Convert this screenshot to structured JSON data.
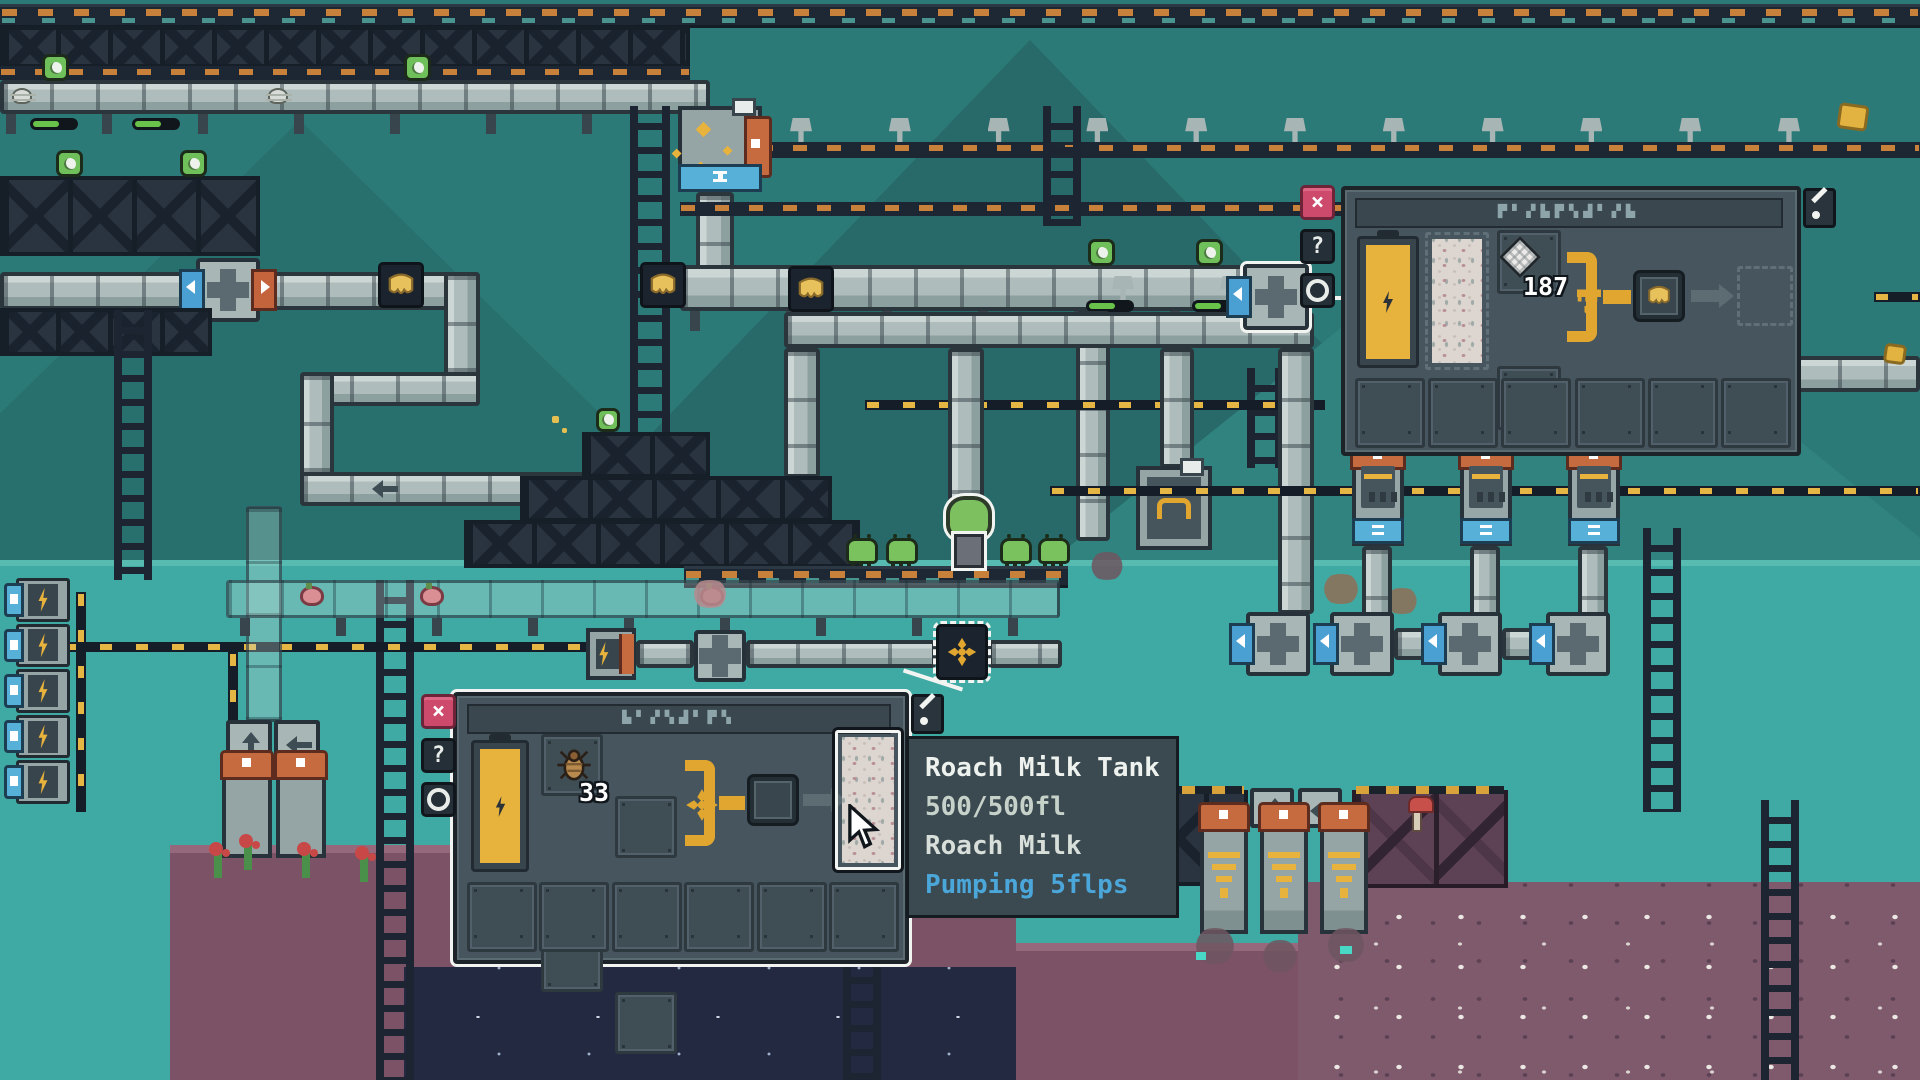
{
  "scene": {
    "type": "pixel-art factory automation game world"
  },
  "ui": {
    "right_panel": {
      "title_glyphs": "▛▘▞▙▛▚▟▘▞▙",
      "close": "×",
      "help": "?",
      "info_icon": "circle-ring",
      "tool_icon": "pick",
      "input_count": "187"
    },
    "bottom_panel": {
      "title_glyphs": "▙▘▞▚▟▘▛▚",
      "close": "×",
      "help": "?",
      "info_icon": "circle-ring",
      "tool_icon": "pick",
      "input_count": "33"
    },
    "tooltip": {
      "title": "Roach Milk Tank",
      "capacity": "500/500fl",
      "contents": "Roach Milk",
      "status": "Pumping 5flps"
    }
  },
  "colors": {
    "sky_teal": "#2c7a78",
    "midband_teal": "#3faaa3",
    "panel_bg": "#47565e",
    "close_pink": "#ce4a6c",
    "status_blue": "#4ba6da",
    "battery_yellow": "#e8b33c",
    "bracket_yellow": "#e0a62f",
    "flag_blue": "#4aa0d2",
    "cap_orange": "#c66a40",
    "ground_purple": "#7b5266",
    "cave_navy": "#232940"
  }
}
